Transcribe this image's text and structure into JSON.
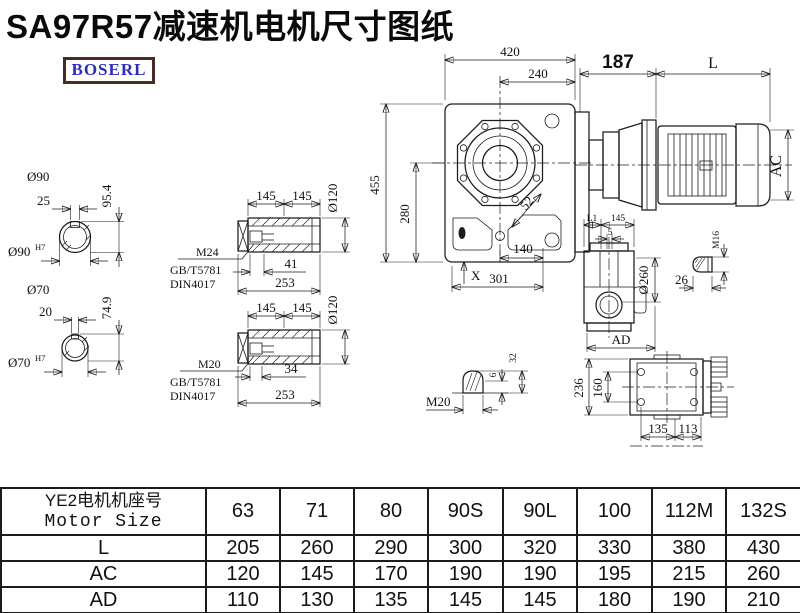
{
  "title": "SA97R57减速机电机尺寸图纸",
  "logo": {
    "text": "BOSERL"
  },
  "colors": {
    "background": "#ffffff",
    "line": "#1c1c1c",
    "title": "#0a0a0a",
    "logo_text": "#2d2dbd",
    "logo_border": "#4c2a24"
  },
  "main_view": {
    "width_top": "420",
    "width_inner": "240",
    "adapter_length": "187",
    "motor_length": "L",
    "height_total": "455",
    "height_center": "280",
    "dim_52": "52",
    "foot": "X",
    "bottom_inner": "140",
    "bottom_total": "301",
    "motor_diameter": "AC"
  },
  "shaft_large": {
    "label": "Ø90",
    "key_width": "25",
    "key_depth": "95.4",
    "bore": "Ø90",
    "bore_tol": "H7"
  },
  "shaft_small": {
    "label": "Ø70",
    "key_width": "20",
    "key_depth": "74.9",
    "bore": "Ø70",
    "bore_tol": "H7"
  },
  "sleeve_top": {
    "seg1": "145",
    "seg2": "145",
    "od": "Ø120",
    "thread": "M24",
    "std1": "GB/T5781",
    "std2": "DIN4017",
    "thread_len": "41",
    "total_len": "253"
  },
  "sleeve_bottom": {
    "seg1": "145",
    "seg2": "145",
    "od": "Ø120",
    "thread": "M20",
    "std1": "GB/T5781",
    "std2": "DIN4017",
    "thread_len": "34",
    "total_len": "253"
  },
  "side_view": {
    "l1": "L1",
    "w145": "145",
    "offset5": "5",
    "flange_od": "Ø260",
    "ad": "AD",
    "bolt_thread": "M16",
    "bolt_len": "26"
  },
  "plug_detail": {
    "thread": "M20",
    "h6": "6",
    "h32": "32"
  },
  "bottom_view": {
    "height": "236",
    "hole_v": "160",
    "hole_h1": "135",
    "hole_h2": "113"
  },
  "table": {
    "header": {
      "line1": "YE2电机机座号",
      "line2": "Motor Size"
    },
    "columns": [
      "63",
      "71",
      "80",
      "90S",
      "90L",
      "100",
      "112M",
      "132S"
    ],
    "rows": [
      {
        "label": "L",
        "values": [
          "205",
          "260",
          "290",
          "300",
          "320",
          "330",
          "380",
          "430"
        ]
      },
      {
        "label": "AC",
        "values": [
          "120",
          "145",
          "170",
          "190",
          "190",
          "195",
          "215",
          "260"
        ]
      },
      {
        "label": "AD",
        "values": [
          "110",
          "130",
          "135",
          "145",
          "145",
          "180",
          "190",
          "210"
        ]
      }
    ]
  }
}
